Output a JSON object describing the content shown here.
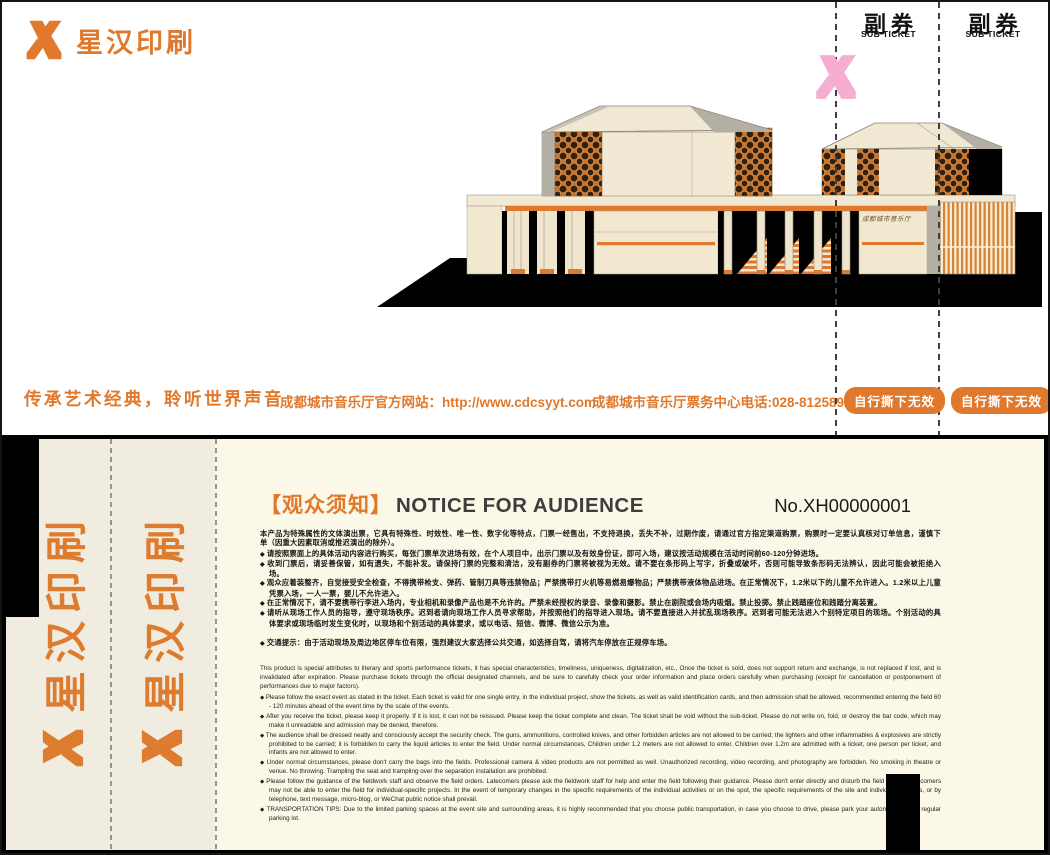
{
  "colors": {
    "accent": "#e0792c",
    "pink_watermark": "#f6aed0",
    "ticket_cream": "#fcf8e7",
    "stub_cream": "#f0ece0",
    "building_cream": "#f2e9d4",
    "lattice_orange": "#cb752d"
  },
  "brand": {
    "name": "星汉印刷"
  },
  "front": {
    "sub_ticket_label": "副券",
    "sub_ticket_sublabel": "SUB TICKET",
    "tear_label": "自行撕下无效",
    "tagline": "传承艺术经典，聆听世界声音",
    "website": "成都城市音乐厅官方网站：http://www.cdcsyyt.com",
    "hotline": "成都城市音乐厅票务中心电话:028-81258957",
    "building_sign": "成都城市音乐厅"
  },
  "back": {
    "stub_brand": "星汉印刷",
    "notice_title_zh": "【观众须知】",
    "notice_title_en": "NOTICE FOR AUDIENCE",
    "ticket_no": "No.XH00000001",
    "zh_intro": "本产品为特殊属性的文体演出票，它具有特殊性、时效性、唯一性、数字化等特点，门票一经售出，不支持退换，丢失不补，过期作废，请通过官方指定渠道购票，购票时一定要认真核对订单信息，谨慎下单（因重大因素取消或推迟演出的除外）。",
    "zh_items": [
      "请按照票面上的具体活动内容进行购买，每张门票单次进场有效，在个人项目中，出示门票以及有效身份证，即可入场，建议按活动规模在活动时间前60-120分钟进场。",
      "收到门票后，请妥善保管，如有遗失，不能补发。请保持门票的完整和清洁，没有副券的门票将被视为无效。请不要在条形码上写字，折叠或破坏，否则可能导致条形码无法辨认，因此可能会被拒绝入场。",
      "观众应着装整齐，自觉接受安全检查，不得携带枪支、弹药、管制刀具等违禁物品；严禁携带打火机等易燃易爆物品；严禁携带液体物品进场。在正常情况下，1.2米以下的儿童不允许进入。1.2米以上儿童凭票入场，一人一票，婴儿不允许进入。",
      "在正常情况下，请不要携带行李进入场内，专业相机和录像产品也是不允许的。严禁未经授权的录音、录像和摄影。禁止在剧院或会场内吸烟。禁止投掷。禁止践踏座位和践踏分离装置。",
      "请听从现场工作人员的指导，遵守现场秩序。迟到者请向现场工作人员寻求帮助，并按照他们的指导进入现场。请不要直接进入并扰乱现场秩序。迟到者可能无法进入个别特定项目的现场。个别活动的具体要求或现场临时发生变化时，以现场和个别活动的具体要求，或以电话、短信、微博、微信公示为准。"
    ],
    "zh_traffic": "交通提示：由于活动现场及周边地区停车位有限，强烈建议大家选择公共交通，如选择自驾，请将汽车停放在正规停车场。",
    "en_intro": "This product is special attributes to literary and sports performance tickets, it has special characteristics, timeliness, uniqueness, digitalization, etc., Once the ticket is sold, does not support return and exchange, is not replaced if lost, and is invalidated after expiration. Please purchase tickets through the official designated channels, and be sure to carefully check your order information and place orders carefully when purchasing (except for cancellation or postponement of performances due to major factors).",
    "en_items": [
      "Please follow the exact event as stated in the ticket. Each ticket is valid for one single entry, in the individual project, show the tickets, as well as valid identification cards, and then admission shall be allowed. recommended entering the field 60 - 120 minutes ahead of the event time by the scale of the events.",
      "After you receive the ticket, please keep it properly. If it is lost, it can not be reissued. Please keep the ticket complete and clean. The ticket shall be void without the sub-ticket. Please do not write on, fold, or destroy the bar code, which may make it unreadable and admission may be denied, therefore.",
      "The audience shall be dressed neatly and consciously accept the security check. The guns, ammunitions, controlled knives, and other forbidden articles are not allowed to be carried; the lighters and other inflammables & explosives are strictly prohibited to be carried; it is forbidden to carry the liquid articles to enter the field. Under normal circumstances, Children under 1.2 meters are not allowed to enter. Children over 1.2m are admitted with a ticket, one person per ticket, and infants are not allowed to enter.",
      "Under normal circumstances, please don't carry the bags into the fields. Professional camera & video products are not permitted as well. Unauthorized recording, video recording, and photography are forbidden. No smoking in theatre or venue. No throwing. Trampling the seat and trampling over the separation installation are prohibited.",
      "Please follow the guidance of the fieldwork staff and observe the field orders. Latecomers please ask the fieldwork staff for help and enter the field following their guidance. Please don't enter directly and disturb the field orders. Latecomers may not be able to enter the field for individual-specific projects. In the event of temporary changes in the specific requirements of the individual activities or on the spot, the specific requirements of the site and individual activities, or by telephone, text message, micro-blog, or WeChat public notice shall prevail.",
      "TRANSPORTATION TIPS: Due to the limited parking spaces at the event site and surrounding areas, it is highly recommended that you choose public transportation, in case you choose to drive, please park your automobile in the regular parking lot."
    ]
  }
}
